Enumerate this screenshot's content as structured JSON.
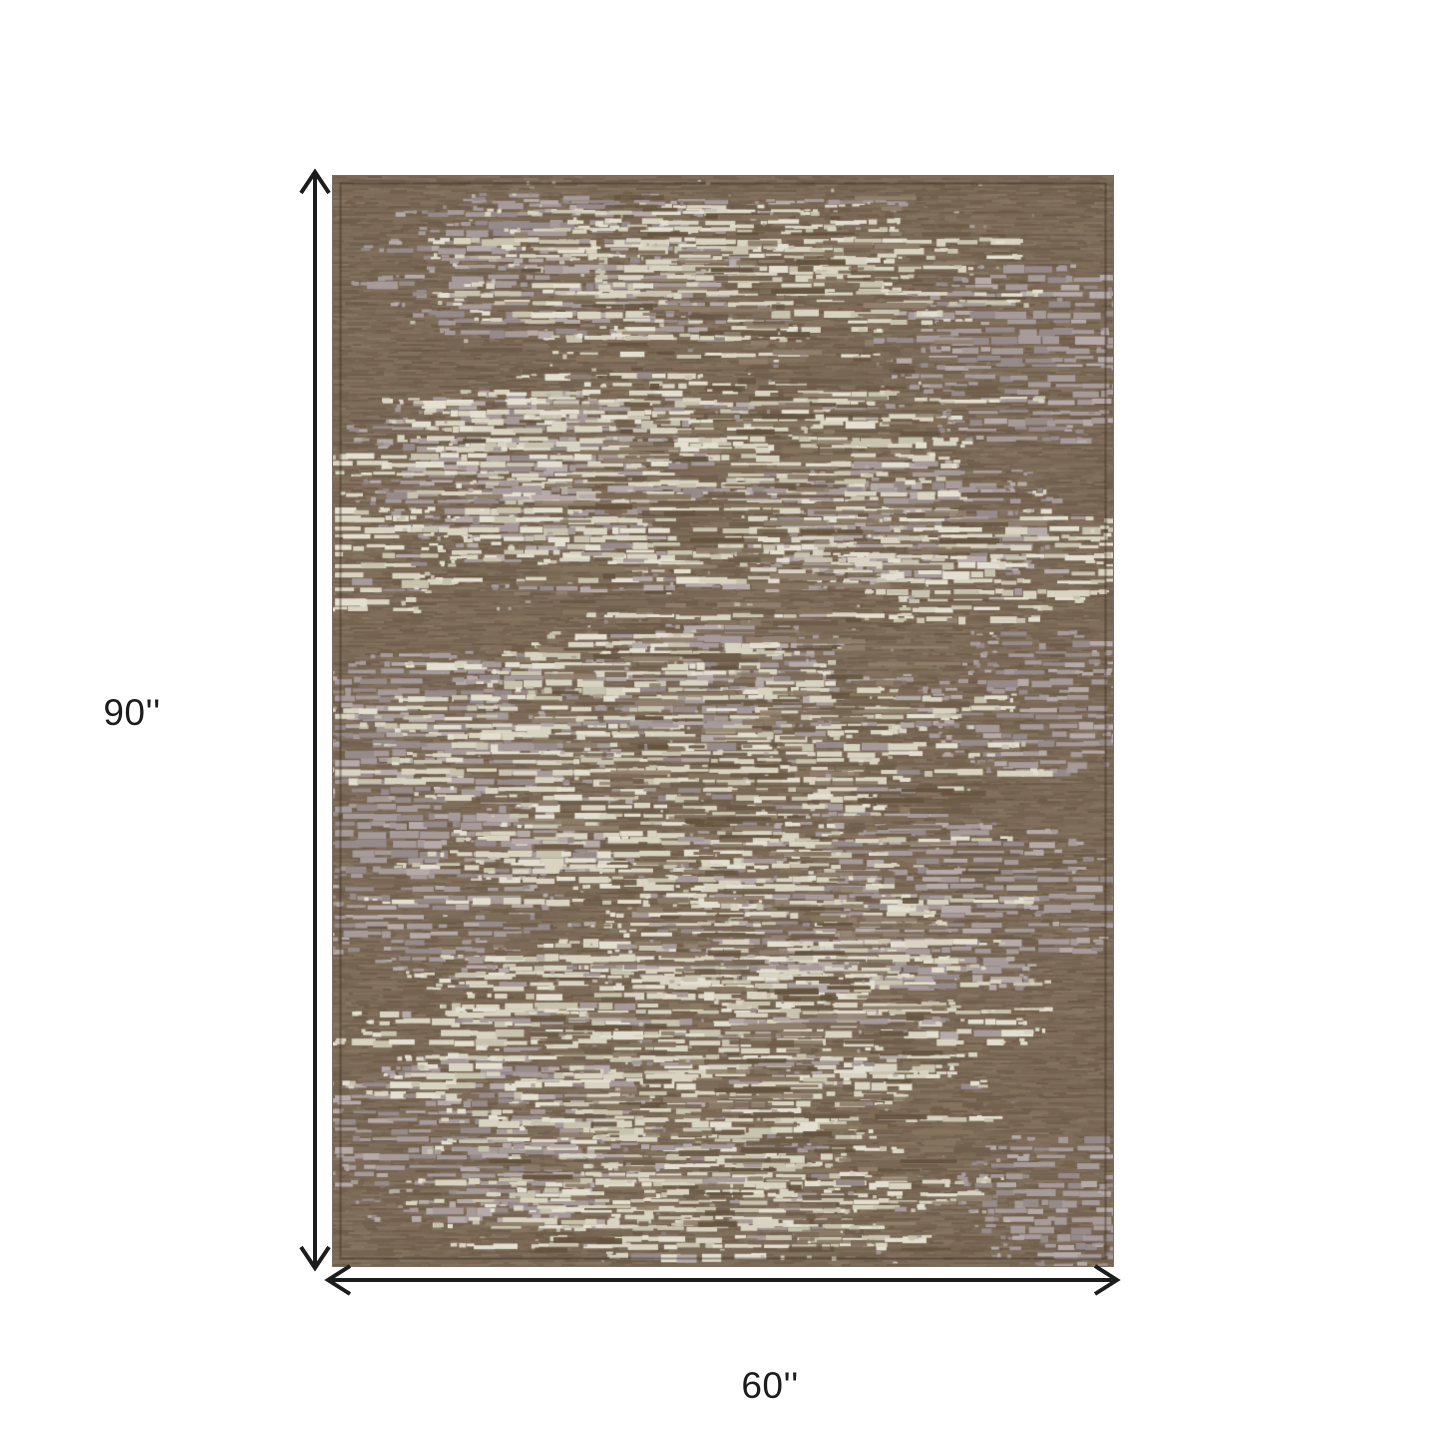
{
  "page": {
    "background_color": "#ffffff",
    "description_label": "rug dimension diagram"
  },
  "diagram": {
    "height_label": "90''",
    "width_label": "60''",
    "line_color": "#1c1c1c",
    "label_color": "#1c1c1c",
    "rug_colors": {
      "base_brown": "#7c6a58",
      "brown_dark": "#64533f",
      "brown_deep": "#574733",
      "brown_light": "#90806d",
      "cream": "#d9d4c2",
      "cream_light": "#e4e0d1",
      "cream_dark": "#c8c3ae",
      "mauve": "#a69a9a",
      "mauve_light": "#b6abaa",
      "mauve_dark": "#968a8b",
      "seam": "rgba(52,42,32,0.45)"
    }
  }
}
